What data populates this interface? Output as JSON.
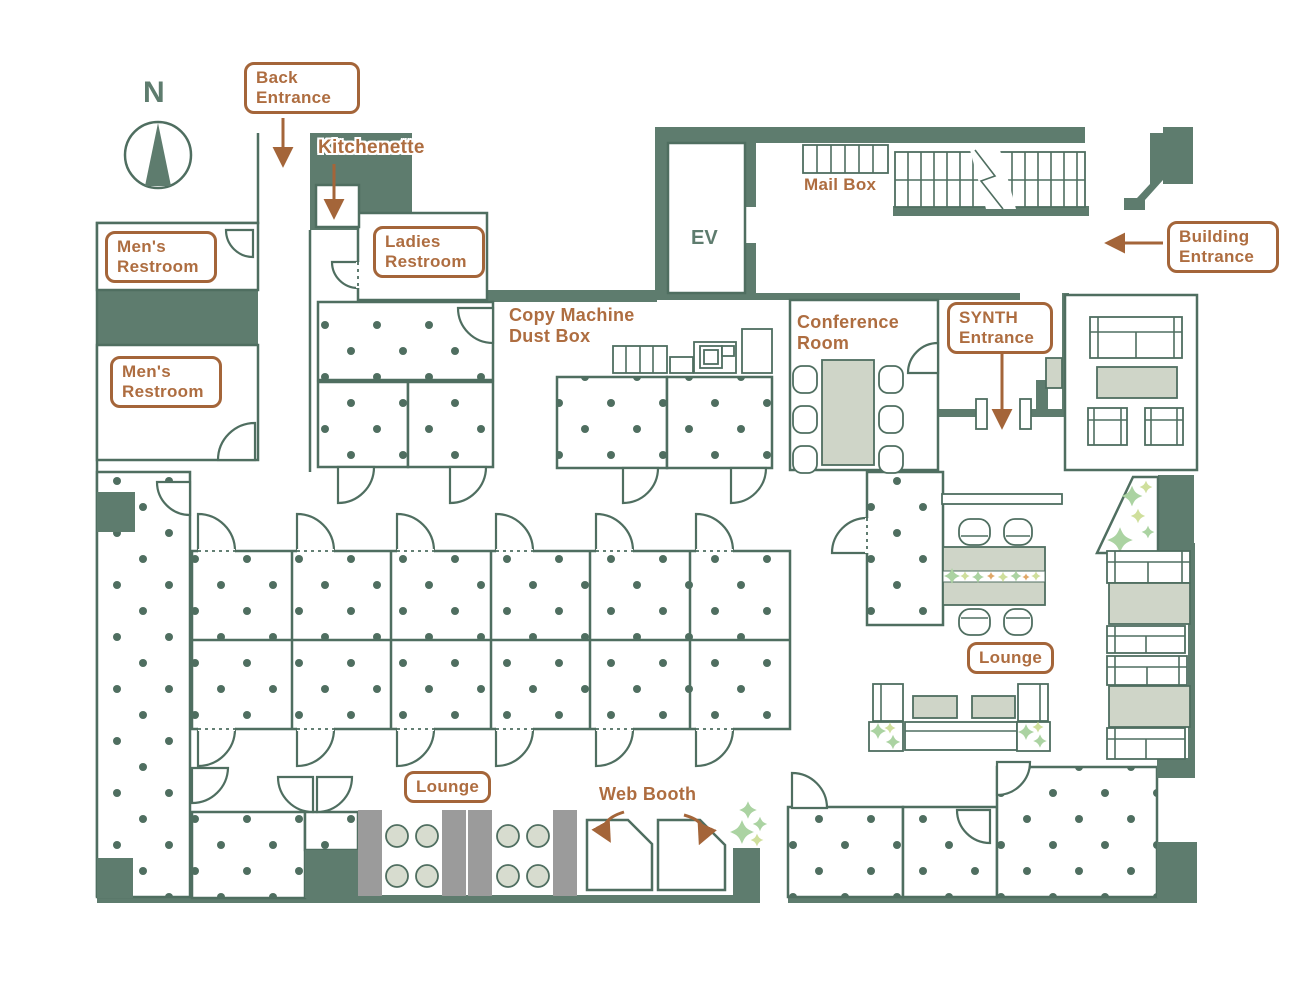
{
  "compass": {
    "north_label": "N"
  },
  "labels": {
    "back_entrance": "Back Entrance",
    "kitchenette": "Kitchenette",
    "mens_restroom_upper": "Men's Restroom",
    "ladies_restroom": "Ladies Restroom",
    "mens_restroom_lower": "Men's Restroom",
    "copy_machine_dust_box": "Copy Machine Dust Box",
    "ev": "EV",
    "mail_box": "Mail Box",
    "building_entrance": "Building Entrance",
    "conference_room": "Conference Room",
    "synth_entrance": "SYNTH Entrance",
    "lounge_right": "Lounge",
    "lounge_bottom": "Lounge",
    "web_booth": "Web Booth"
  },
  "colors": {
    "wall_green": "#5e7c6e",
    "line_green": "#4f6e60",
    "label_brown": "#ae6d40",
    "label_border_brown": "#a46539",
    "furniture_fill": "#cfd5c8",
    "bench_gray": "#9b9b9b",
    "plant_green": "#abd3a2",
    "plant_yellow_green": "#cfdf9c",
    "plant_orange": "#e0a868"
  }
}
